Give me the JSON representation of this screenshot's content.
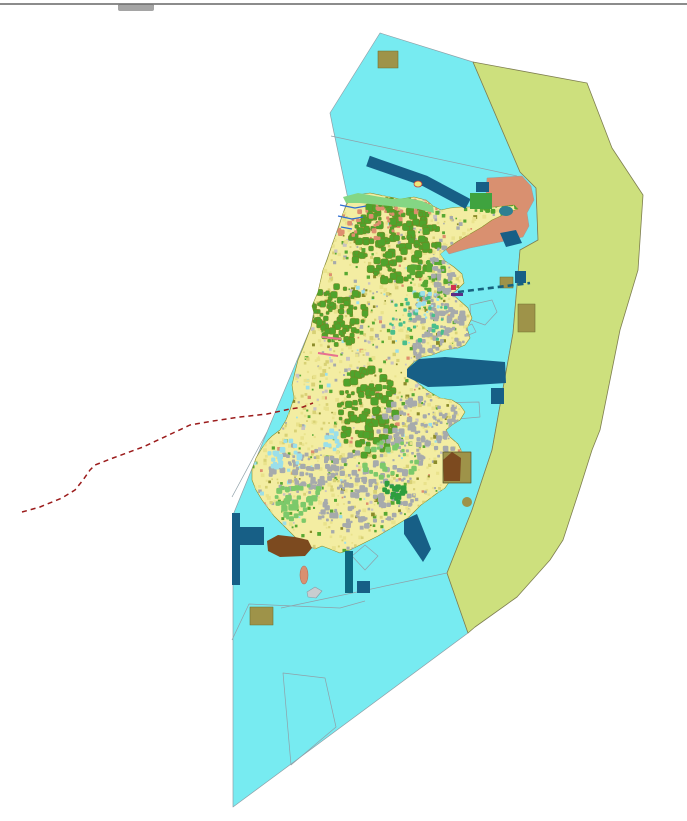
{
  "window": {
    "top_border_color": "#8c8c8c",
    "top_notch_color": "#a5a5a5"
  },
  "palette": {
    "background": "#ffffff",
    "marine_zone": "#77EBF1",
    "buffer_zone": "#CDE07D",
    "salmon_zone": "#D99070",
    "island_base": "#F3EDA2",
    "forest_green": "#4FA32C",
    "urban_gray": "#A6AAAC",
    "navy_blue": "#175F86",
    "teal_dark": "#0F6880",
    "khaki": "#9E9349",
    "brown": "#7C4A1F",
    "dashed_route_red": "#9B1B1B",
    "boundary_gray": "#8FA0A8"
  },
  "map": {
    "viewBox": "0 0 687 821",
    "island_outline": "350,198 346,206 342,216 339,226 335,237 331,248 327,260 323,270 318,292 312,306 314,313 311,327 303,348 298,360 295,372 292,385 294,398 290,410 286,420 280,430 272,436 268,440 262,448 256,458 252,470 252,480 256,490 262,500 268,508 274,516 282,524 290,532 298,540 306,545 315,549 322,546 330,549 340,553 350,550 358,546 368,541 378,536 388,530 398,524 408,518 415,511 421,505 428,500 436,494 445,488 452,478 448,468 456,460 462,452 458,444 450,437 446,430 452,425 460,420 465,412 460,405 452,400 440,398 428,391 419,384 411,377 408,368 414,362 422,357 432,355 445,350 458,348 465,345 470,338 467,328 472,318 468,308 459,300 452,294 458,289 464,283 462,274 454,267 445,261 440,254 449,247 458,241 470,234 482,227 492,220 503,215 512,211 518,209 514,205 505,206 494,207 483,208 472,207 461,207 450,208 441,210 433,206 426,200 414,197 400,199 385,196 370,193 357,195",
    "layers": [
      {
        "name": "zones",
        "items": [
          {
            "type": "polygon",
            "name": "marine-zone",
            "points": "380,33 473,62 520,172 536,188 538,240 520,250 513,333 492,450 472,510 447,573 468,633 233,807 233,515 267,432 298,358 311,327 316,300 325,265 338,228 348,199 333,128 330,113",
            "fill": "#77EBF1",
            "stroke": "#8FA0A8",
            "sw": 0.7
          },
          {
            "type": "polygon",
            "name": "buffer-zone",
            "points": "473,62 587,83 612,148 643,195 638,270 620,330 600,430 592,450 580,488 563,540 550,560 517,597 475,627 468,633 447,573 472,510 492,450 513,333 520,250 538,240 536,188 520,172",
            "fill": "#CDE07D",
            "stroke": "#7E7E50",
            "sw": 0.8
          },
          {
            "type": "polygon",
            "name": "salmon-zone",
            "points": "487,178 522,176 531,186 534,200 527,213 529,226 523,237 505,241 470,248 449,254 444,247 458,237 472,228 483,219 490,208 486,196",
            "fill": "#D99070",
            "stroke": "#9a9a9a",
            "sw": 0.5
          }
        ]
      },
      {
        "name": "water-boundaries",
        "items": [
          {
            "type": "polyline",
            "name": "parcel-line",
            "points": "331,136 517,176",
            "fill": "none",
            "stroke": "#8FA0A8",
            "sw": 0.7
          },
          {
            "type": "polyline",
            "name": "parcel-line",
            "points": "232,640 249,604 340,608 365,601",
            "fill": "none",
            "stroke": "#8FA0A8",
            "sw": 0.7
          },
          {
            "type": "polyline",
            "name": "parcel-line",
            "points": "281,608 447,573",
            "fill": "none",
            "stroke": "#8FA0A8",
            "sw": 0.7
          },
          {
            "type": "polygon",
            "name": "parcel-outline",
            "points": "283,673 325,678 336,727 291,765",
            "fill": "none",
            "stroke": "#8FA0A8",
            "sw": 0.7
          },
          {
            "type": "polygon",
            "name": "parcel-outline",
            "points": "352,556 365,545 378,556 365,570",
            "fill": "none",
            "stroke": "#8FA0A8",
            "sw": 0.7
          },
          {
            "type": "polygon",
            "name": "parcel-outline",
            "points": "430,403 479,402 480,417 446,420 431,412",
            "fill": "none",
            "stroke": "#8FA0A8",
            "sw": 0.7
          },
          {
            "type": "polygon",
            "name": "parcel-outline",
            "points": "470,305 492,300 497,312 485,325 471,320",
            "fill": "none",
            "stroke": "#8FA0A8",
            "sw": 0.7
          },
          {
            "type": "polygon",
            "name": "parcel-outline",
            "points": "463,328 472,324 476,332 466,336",
            "fill": "none",
            "stroke": "#8FA0A8",
            "sw": 0.7
          },
          {
            "type": "polyline",
            "name": "parcel-line",
            "points": "267,432 232,497",
            "fill": "none",
            "stroke": "#8FA0A8",
            "sw": 0.7
          }
        ]
      },
      {
        "name": "island",
        "items": [
          {
            "type": "island-base",
            "name": "island-landmass",
            "fill": "#F3EDA2",
            "stroke": "#8B8B2A",
            "sw": 0.6
          }
        ]
      },
      {
        "name": "island-texture",
        "clip": true,
        "texture": {
          "seed": 1337,
          "noise": {
            "n": 2600,
            "bbox": [
              246,
              193,
              272,
              368
            ],
            "smin": 1.5,
            "smax": 4,
            "palette": [
              {
                "c": "#E9E28C",
                "w": 5
              },
              {
                "c": "#D8D175",
                "w": 3
              },
              {
                "c": "#A6AAAC",
                "w": 2
              },
              {
                "c": "#57A832",
                "w": 2
              },
              {
                "c": "#C8C2C0",
                "w": 1
              },
              {
                "c": "#9ADFEA",
                "w": 0.6
              },
              {
                "c": "#DE8E6E",
                "w": 0.6
              },
              {
                "c": "#8B8B2A",
                "w": 0.8
              }
            ]
          },
          "clusters": [
            {
              "name": "forest-north",
              "cx": 395,
              "cy": 240,
              "rx": 45,
              "ry": 42,
              "n": 150,
              "smin": 3,
              "smax": 8,
              "fill": "#4FA32C",
              "stroke": "#7d7d20"
            },
            {
              "name": "forest-west",
              "cx": 338,
              "cy": 315,
              "rx": 28,
              "ry": 30,
              "n": 85,
              "smin": 3,
              "smax": 7,
              "fill": "#4FA32C",
              "stroke": "#7d7d20"
            },
            {
              "name": "forest-central",
              "cx": 368,
              "cy": 412,
              "rx": 30,
              "ry": 46,
              "n": 115,
              "smin": 3,
              "smax": 8,
              "fill": "#4FA32C",
              "stroke": "#7d7d20"
            },
            {
              "name": "forest-ne",
              "cx": 430,
              "cy": 280,
              "rx": 25,
              "ry": 20,
              "n": 40,
              "smin": 2,
              "smax": 6,
              "fill": "#57A832"
            },
            {
              "name": "forest-ne-tip",
              "cx": 500,
              "cy": 205,
              "rx": 18,
              "ry": 10,
              "n": 25,
              "smin": 2,
              "smax": 5,
              "fill": "#4FA32C"
            },
            {
              "name": "urban-east",
              "cx": 438,
              "cy": 330,
              "rx": 28,
              "ry": 45,
              "n": 115,
              "smin": 2,
              "smax": 6,
              "fill": "#A6AAAC"
            },
            {
              "name": "urban-southeast",
              "cx": 420,
              "cy": 430,
              "rx": 45,
              "ry": 35,
              "n": 115,
              "smin": 2,
              "smax": 6,
              "fill": "#A6AAAC"
            },
            {
              "name": "urban-south",
              "cx": 360,
              "cy": 490,
              "rx": 55,
              "ry": 38,
              "n": 130,
              "smin": 2,
              "smax": 6,
              "fill": "#A6AAAC"
            },
            {
              "name": "urban-southwest",
              "cx": 300,
              "cy": 470,
              "rx": 30,
              "ry": 26,
              "n": 55,
              "smin": 2,
              "smax": 6,
              "fill": "#A6AAAC"
            },
            {
              "name": "urban-ne",
              "cx": 450,
              "cy": 268,
              "rx": 20,
              "ry": 25,
              "n": 50,
              "smin": 2,
              "smax": 5,
              "fill": "#A6AAAC"
            },
            {
              "name": "meadow-south",
              "cx": 300,
              "cy": 502,
              "rx": 25,
              "ry": 20,
              "n": 35,
              "smin": 3,
              "smax": 7,
              "fill": "#7CC96A"
            },
            {
              "name": "meadow-central",
              "cx": 390,
              "cy": 460,
              "rx": 30,
              "ry": 20,
              "n": 25,
              "smin": 3,
              "smax": 6,
              "fill": "#7CC96A"
            },
            {
              "name": "park-bright",
              "cx": 395,
              "cy": 492,
              "rx": 13,
              "ry": 12,
              "n": 22,
              "smin": 3,
              "smax": 6,
              "fill": "#2E9E3E"
            },
            {
              "name": "wetland-teal",
              "cx": 420,
              "cy": 320,
              "rx": 30,
              "ry": 30,
              "n": 32,
              "smin": 2,
              "smax": 5,
              "fill": "#49BE8C"
            },
            {
              "name": "ponds-west",
              "cx": 285,
              "cy": 455,
              "rx": 18,
              "ry": 15,
              "n": 20,
              "smin": 3,
              "smax": 6,
              "fill": "#9ADFEA"
            },
            {
              "name": "ponds-mid",
              "cx": 330,
              "cy": 440,
              "rx": 15,
              "ry": 10,
              "n": 10,
              "smin": 3,
              "smax": 5,
              "fill": "#9ADFEA"
            },
            {
              "name": "ponds-ne",
              "cx": 430,
              "cy": 303,
              "rx": 15,
              "ry": 18,
              "n": 15,
              "smin": 2,
              "smax": 5,
              "fill": "#9ADFEA"
            },
            {
              "name": "residential-north",
              "cx": 370,
              "cy": 225,
              "rx": 35,
              "ry": 18,
              "n": 32,
              "smin": 2,
              "smax": 5,
              "fill": "#DE8E6E"
            },
            {
              "name": "residential-coast",
              "cx": 400,
              "cy": 206,
              "rx": 40,
              "ry": 10,
              "n": 20,
              "smin": 2,
              "smax": 4,
              "fill": "#DE8E6E"
            }
          ]
        }
      },
      {
        "name": "coast-details",
        "items": [
          {
            "type": "polygon",
            "name": "north-shore-strip",
            "points": "343,197 358,193 375,196 392,199 408,198 422,201 433,206 434,213 418,209 400,207 380,205 360,203 346,203",
            "fill": "#84D684",
            "stroke": "none",
            "sw": 0
          },
          {
            "type": "polyline",
            "name": "stream",
            "points": "340,205 355,208 366,206",
            "fill": "none",
            "stroke": "#2F6FD0",
            "sw": 1.2
          },
          {
            "type": "polyline",
            "name": "stream",
            "points": "338,216 352,219 363,217",
            "fill": "none",
            "stroke": "#2F6FD0",
            "sw": 1.2
          },
          {
            "type": "polyline",
            "name": "stream",
            "points": "341,227 352,229",
            "fill": "none",
            "stroke": "#2F6FD0",
            "sw": 1.2
          },
          {
            "type": "polyline",
            "name": "coast-road-pink",
            "points": "322,337 341,339",
            "fill": "none",
            "stroke": "#E87090",
            "sw": 2
          },
          {
            "type": "polyline",
            "name": "coast-road-pink",
            "points": "318,353 338,356",
            "fill": "none",
            "stroke": "#E87090",
            "sw": 2
          }
        ]
      },
      {
        "name": "marine-structures",
        "items": [
          {
            "type": "polyline",
            "name": "shipping-channel-band",
            "points": "368,161 425,181 468,204",
            "fill": "none",
            "stroke": "#175F86",
            "sw": 11
          },
          {
            "type": "rect",
            "name": "dock-rect",
            "x": 476,
            "y": 182,
            "w": 13,
            "h": 10,
            "fill": "#175F86"
          },
          {
            "type": "rect",
            "name": "green-plot-ne",
            "x": 470,
            "y": 193,
            "w": 22,
            "h": 16,
            "fill": "#3FA33F"
          },
          {
            "type": "ellipse",
            "name": "lagoon-ne",
            "cx": 506,
            "cy": 211,
            "rx": 7,
            "ry": 5,
            "fill": "#2E7F92"
          },
          {
            "type": "polygon",
            "name": "dock-parallelogram",
            "points": "500,233 516,230 522,243 506,247",
            "fill": "#175F86"
          },
          {
            "type": "polygon",
            "name": "harbor-basin-east",
            "points": "407,369 419,359 445,357 505,362 506,383 458,386 428,387 407,377",
            "fill": "#175F86"
          },
          {
            "type": "rect",
            "name": "harbor-small-east",
            "x": 491,
            "y": 388,
            "w": 13,
            "h": 16,
            "fill": "#175F86"
          },
          {
            "type": "rect",
            "name": "anchorage-square",
            "x": 515,
            "y": 271,
            "w": 11,
            "h": 12,
            "fill": "#175F86"
          },
          {
            "type": "rect",
            "name": "jetty-west-vertical",
            "x": 232,
            "y": 513,
            "w": 8,
            "h": 72,
            "fill": "#175F86"
          },
          {
            "type": "rect",
            "name": "jetty-west-horizontal",
            "x": 240,
            "y": 527,
            "w": 24,
            "h": 18,
            "fill": "#175F86"
          },
          {
            "type": "rect",
            "name": "pier-south",
            "x": 345,
            "y": 551,
            "w": 8,
            "h": 42,
            "fill": "#0F6880"
          },
          {
            "type": "rect",
            "name": "platform-south",
            "x": 357,
            "y": 581,
            "w": 13,
            "h": 12,
            "fill": "#175F86"
          },
          {
            "type": "polygon",
            "name": "breakwater-southeast",
            "points": "404,520 417,514 431,549 423,562 404,534",
            "fill": "#175F86"
          }
        ]
      },
      {
        "name": "special-areas",
        "items": [
          {
            "type": "rect",
            "name": "khaki-area-north",
            "x": 378,
            "y": 51,
            "w": 20,
            "h": 17,
            "fill": "#9E9349",
            "stroke": "#6f6f30",
            "sw": 0.6
          },
          {
            "type": "rect",
            "name": "khaki-area-east-small",
            "x": 500,
            "y": 277,
            "w": 13,
            "h": 11,
            "fill": "#9E9349",
            "stroke": "#6f6f30",
            "sw": 0.6
          },
          {
            "type": "rect",
            "name": "khaki-area-east-large",
            "x": 518,
            "y": 304,
            "w": 17,
            "h": 28,
            "fill": "#9E9349",
            "stroke": "#6f6f30",
            "sw": 0.6
          },
          {
            "type": "rect",
            "name": "khaki-area-south",
            "x": 250,
            "y": 607,
            "w": 23,
            "h": 18,
            "fill": "#9E9349",
            "stroke": "#6f6f30",
            "sw": 0.6
          },
          {
            "type": "rect",
            "name": "khaki-compound-southeast",
            "x": 443,
            "y": 452,
            "w": 28,
            "h": 31,
            "fill": "#9E9349",
            "stroke": "#55552a",
            "sw": 0.7
          },
          {
            "type": "polygon",
            "name": "brown-building-southeast",
            "points": "443,460 452,452 461,458 460,481 444,481",
            "fill": "#7C4A1F"
          },
          {
            "type": "ellipse",
            "name": "khaki-blob-small",
            "cx": 467,
            "cy": 502,
            "rx": 5,
            "ry": 5,
            "fill": "#9E9349"
          },
          {
            "type": "polygon",
            "name": "brown-area-southwest",
            "points": "267,541 278,535 295,537 308,540 312,548 305,556 280,557 268,551",
            "fill": "#7C4A1F"
          }
        ]
      },
      {
        "name": "islets-markers",
        "items": [
          {
            "type": "ellipse",
            "name": "islet-yellow",
            "cx": 418,
            "cy": 184,
            "rx": 4,
            "ry": 3,
            "fill": "#EDE77A",
            "stroke": "#c04040",
            "sw": 0.8
          },
          {
            "type": "ellipse",
            "name": "islet-salmon",
            "cx": 304,
            "cy": 575,
            "rx": 4,
            "ry": 9,
            "fill": "#D99070",
            "stroke": "#b5705a",
            "sw": 0.6
          },
          {
            "type": "polygon",
            "name": "islet-gray",
            "points": "307,592 315,587 322,591 316,598 308,597",
            "fill": "#C8CDD0",
            "stroke": "#8a9aa5",
            "sw": 0.6
          },
          {
            "type": "rect",
            "name": "purple-quay-marker",
            "x": 451,
            "y": 293,
            "w": 12,
            "h": 3,
            "fill": "#5B2C86"
          },
          {
            "type": "rect",
            "name": "red-flag-marker",
            "x": 451,
            "y": 285,
            "w": 5,
            "h": 5,
            "fill": "#D13050"
          }
        ]
      },
      {
        "name": "routes",
        "items": [
          {
            "type": "polyline",
            "name": "dashed-boundary-red",
            "points": "22,512 40,507 62,498 75,490 83,480 90,470 95,465 113,458 143,447 173,433 190,425 213,421 240,417 267,414 290,409 303,407 313,403",
            "fill": "none",
            "stroke": "#9B1B1B",
            "sw": 1.5,
            "dash": "5,4"
          },
          {
            "type": "polyline",
            "name": "dashed-ferry-teal",
            "points": "458,292 530,283",
            "fill": "none",
            "stroke": "#17617F",
            "sw": 2.6,
            "dash": "6,4"
          }
        ]
      }
    ]
  }
}
